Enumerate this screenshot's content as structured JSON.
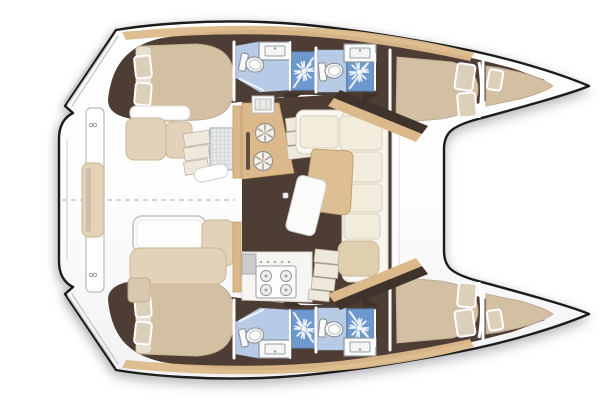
{
  "app": {
    "title": "Catamaran interior layout floor plan",
    "view": "top-down deck and accommodation plan",
    "orientation": {
      "bow": "right",
      "stern": "left",
      "port_hull": "top",
      "starboard_hull": "bottom"
    }
  },
  "colors": {
    "background": "#ffffff",
    "outline": "#1c1c1c",
    "floor": "#4d3d34",
    "floor_dark": "#40332b",
    "wood": "#dcb98a",
    "wood_dark": "#c39c66",
    "upholstery": "#f2ecdd",
    "cushion_tan": "#e2d2ba",
    "mattress": "#d3bfa1",
    "pillow": "#ddd0ba",
    "heads_floor": "#b7cbe6",
    "shower_blue": "#6e99cf",
    "fixture_white": "#fbfbfa",
    "fixture_stroke": "#8e949b",
    "step_gray": "#efe9dd",
    "table_white": "#fdfdfb",
    "deck_shade": "#f2f2f4"
  },
  "rooms": {
    "port_hull": [
      "aft-cabin",
      "aft-heads-with-shower",
      "forward-heads-with-shower",
      "forward-cabin",
      "forepeak-berth"
    ],
    "starboard_hull": [
      "aft-cabin",
      "aft-heads-with-shower",
      "forward-heads-with-shower",
      "forward-cabin",
      "forepeak-berth"
    ],
    "bridgedeck": [
      "salon",
      "galley",
      "chart-table",
      "dining-table",
      "l-sofa",
      "cockpit",
      "aft-bench",
      "helm-station",
      "forward-deck",
      "trampoline",
      "swim-platform"
    ]
  },
  "counts": {
    "cabins": 4,
    "heads": 4,
    "showers": 4,
    "forepeak_berths": 2,
    "stove_burners": 4,
    "galley_round_sinks": 2,
    "companionway_stairs": 2
  },
  "features": {
    "toilet_icon": "white oval bowl with tank",
    "shower_icon": "white sunburst spray on blue square",
    "sink_icon": "rectangular basin on white counter",
    "stove_icon": "four burner circles with knobs",
    "round_sink_icon": "circle with segmented drain",
    "stairs_icon": "stacked treads",
    "helm_seat_icon": "mesh grid square",
    "centerline_style": "gray dashed",
    "bed_icon": "rounded mattress with pillows"
  }
}
